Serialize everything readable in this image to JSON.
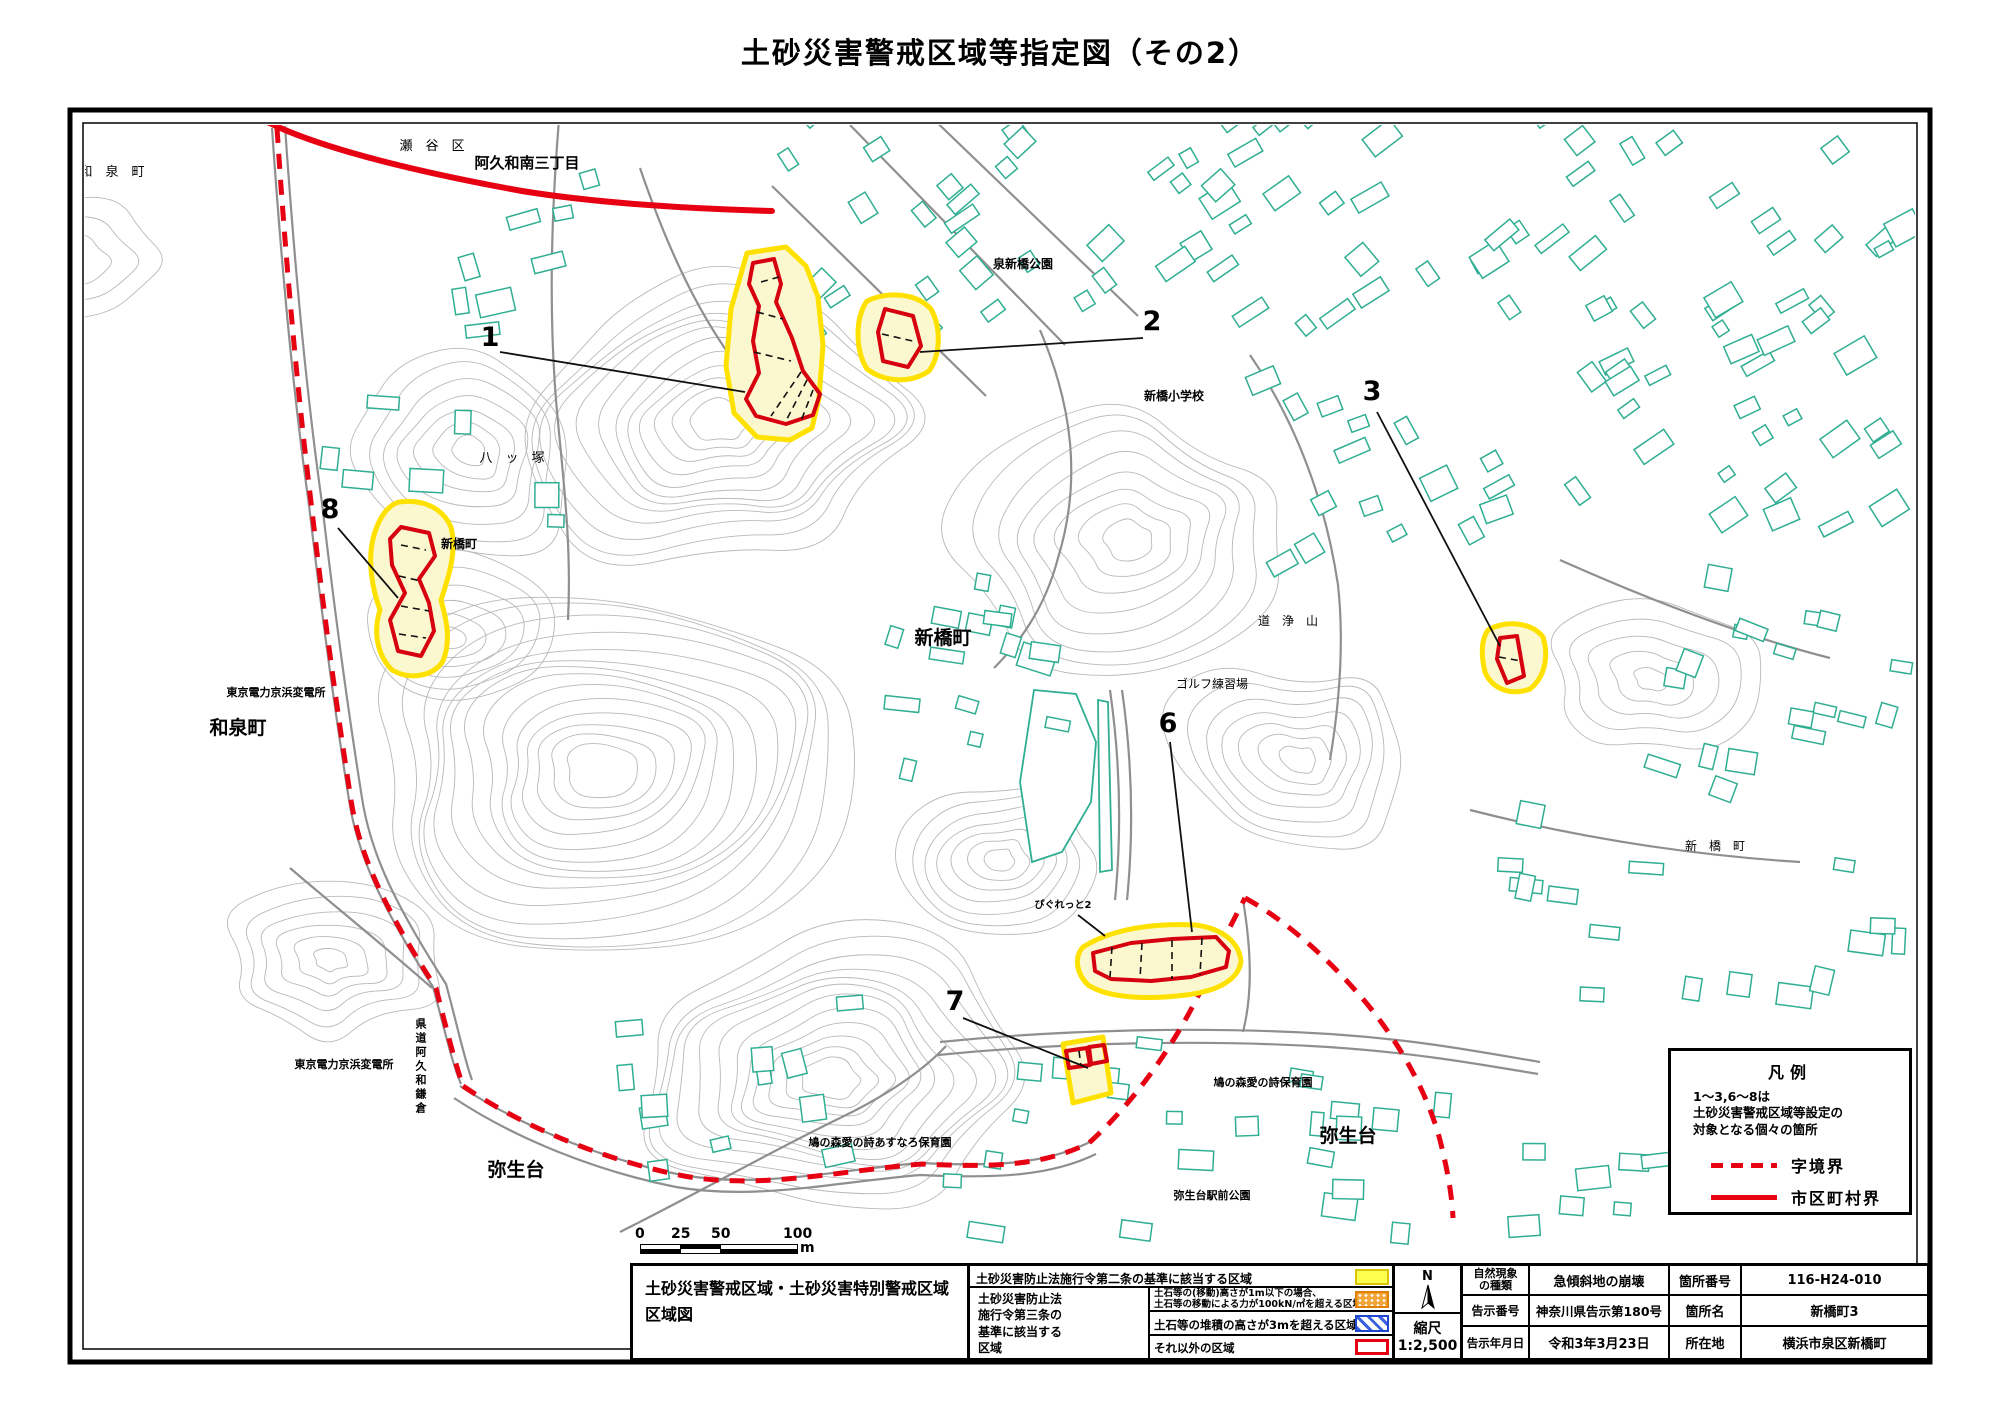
{
  "title": "土砂災害警戒区域等指定図（その2）",
  "map": {
    "labels": {
      "izumicho_top": "和　泉　町",
      "seya_ku": "瀬　谷　区",
      "akuwa_minami3": "阿久和南三丁目",
      "izumi_shinbashi_park": "泉新橋公園",
      "shinbashi_elem": "新橋小学校",
      "yatsuzuka": "八　ッ　塚",
      "shinbashicho_nw": "新橋町",
      "shinbashicho_center": "新橋町",
      "dojoyama": "道　浄　山",
      "golf": "ゴルフ練習場",
      "tepco_n": "東京電力京浜変電所",
      "izumicho_w": "和泉町",
      "tepco_s": "東京電力京浜変電所",
      "kendo": "県道阿久和鎌倉",
      "yayoidai_w": "弥生台",
      "asunaro": "鳩の森愛の詩あすなろ保育園",
      "pigretto": "ぴぐれっと2",
      "hoikuen": "鳩の森愛の詩保育園",
      "yayoidai_e": "弥生台",
      "ekimae_park": "弥生台駅前公園",
      "shinbashicho_e": "新　橋　町"
    },
    "markers": {
      "m1": "1",
      "m2": "2",
      "m3": "3",
      "m6": "6",
      "m7": "7",
      "m8": "8"
    },
    "legend": {
      "title": "凡例",
      "note1": "1～3,6～8は",
      "note2": "土砂災害警戒区域等設定の",
      "note3": "対象となる個々の箇所",
      "dashed_label": "字境界",
      "solid_label": "市区町村界"
    }
  },
  "scalebar": {
    "t0": "0",
    "t25": "25",
    "t50": "50",
    "t100": "100",
    "unit": "m"
  },
  "info_table": {
    "sheet_title1": "土砂災害警戒区域・土砂災害特別警戒区域",
    "sheet_title2": "区域図",
    "law2_text": "土砂災害防止法施行令第二条の基準に該当する区域",
    "law3_l1": "土砂災害防止法",
    "law3_l2": "施行令第三条の",
    "law3_l3": "基準に該当する",
    "law3_l4": "区域",
    "row2_l1": "土石等の(移動)高さが1m以下の場合、",
    "row2_l2": "土石等の移動による力が100kN/㎡を超える区域",
    "row3": "土石等の堆積の高さが3mを超える区域",
    "row4": "それ以外の区域",
    "north": "N",
    "scale_label": "縮尺",
    "scale_value": "1:2,500",
    "nat_h1": "自然現象",
    "nat_h2": "の種類",
    "nat_v": "急傾斜地の崩壊",
    "no_h": "箇所番号",
    "no_v": "116-H24-010",
    "notice_h": "告示番号",
    "notice_v": "神奈川県告示第180号",
    "name_h": "箇所名",
    "name_v": "新橋町3",
    "date_h": "告示年月日",
    "date_v": "令和3年3月23日",
    "loc_h": "所在地",
    "loc_v": "横浜市泉区新橋町"
  },
  "colors": {
    "boundary_red": "#e60012",
    "zone_border_yellow": "#ffe100",
    "zone_fill": "#fbf7cf",
    "special_zone_red": "#d7000f",
    "building_teal": "#2fae92",
    "contour_gray": "#b9b9b9"
  }
}
